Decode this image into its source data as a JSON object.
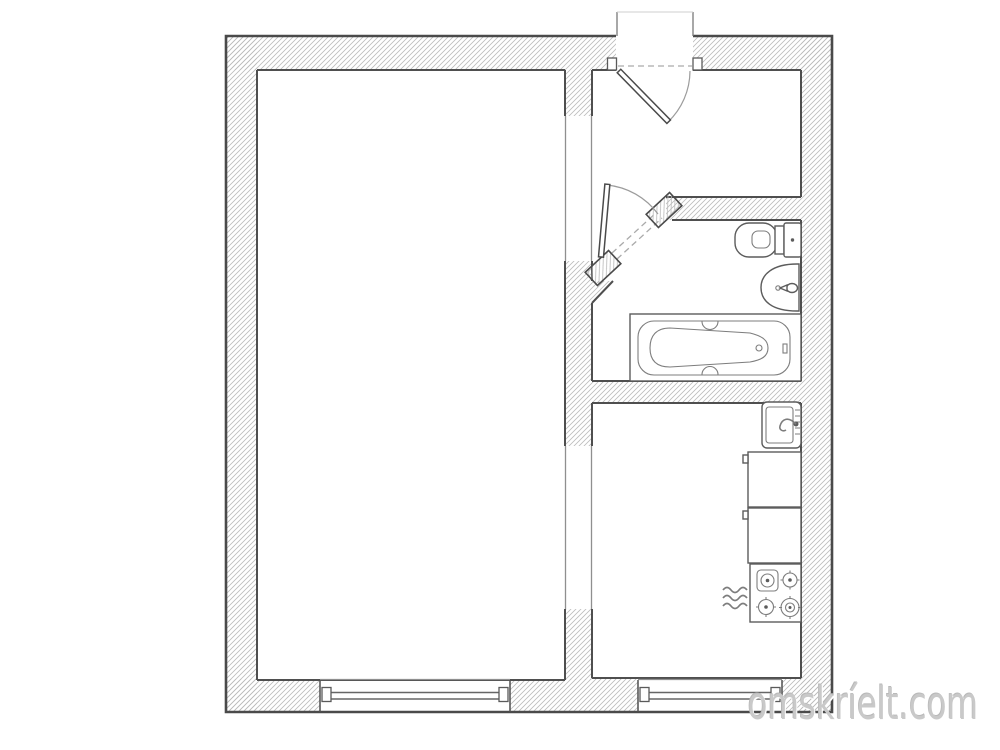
{
  "watermark": {
    "text": "omskríelt.com",
    "color": "#c9c9c9"
  },
  "floor_plan": {
    "kind": "one-room apartment plan",
    "background": "#ffffff",
    "colors": {
      "wall_outline": "#4a4a4a",
      "hatch_lines": "#bcbcbc",
      "thin_partition": "#8f8f8f",
      "door_swing": "#9c9c9c",
      "dashed_opening": "#aaaaaa"
    },
    "rooms": [
      {
        "name": "living-room",
        "features": [
          "window"
        ]
      },
      {
        "name": "hallway",
        "features": [
          "entrance-door",
          "door-swing-arc",
          "entry-notch"
        ]
      },
      {
        "name": "bathroom",
        "features": [
          "diagonal-door",
          "toilet",
          "washbasin",
          "bathtub"
        ]
      },
      {
        "name": "kitchen",
        "features": [
          "sink",
          "counter-cabinet",
          "counter-cabinet",
          "gas-stove",
          "gas-supply-symbol",
          "window"
        ]
      }
    ],
    "counts": {
      "windows": 2,
      "interior_doors": 1,
      "entrance_doors": 1
    }
  }
}
